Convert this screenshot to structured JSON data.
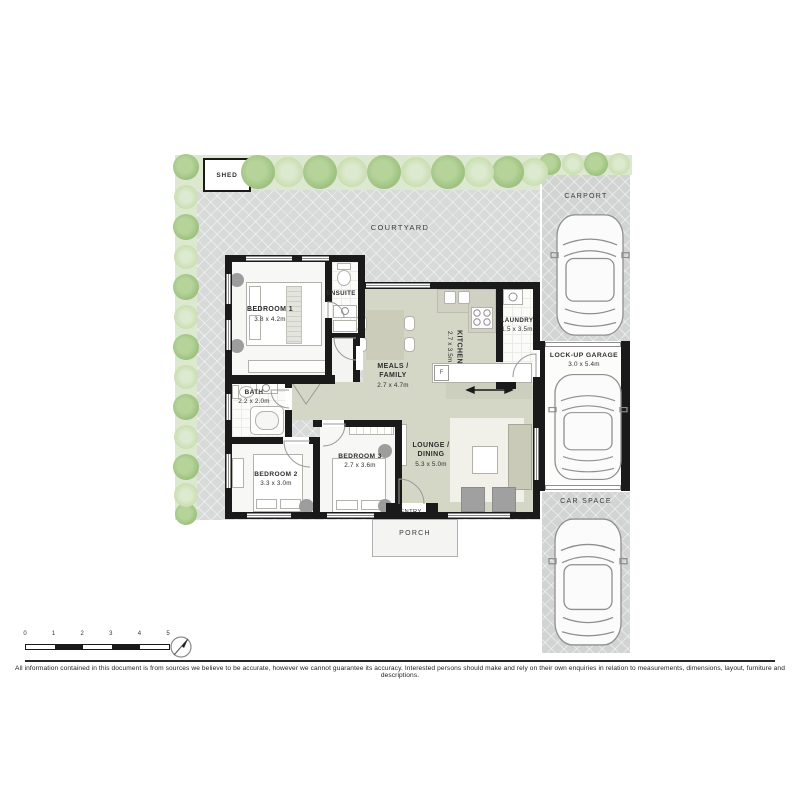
{
  "plan": {
    "shed": {
      "label": "SHED"
    },
    "courtyard": {
      "label": "COURTYARD"
    },
    "rooms": {
      "bedroom1": {
        "name": "BEDROOM 1",
        "dims": "3.8 x 4.2m"
      },
      "ensuite": {
        "name": "ENSUITE"
      },
      "kitchen": {
        "name": "KITCHEN",
        "dims": "2.7 x 3.5m"
      },
      "laundry": {
        "name": "LAUNDRY",
        "dims": "1.5 x 3.5m"
      },
      "meals_family": {
        "name": "MEALS / FAMILY",
        "dims": "2.7 x 4.7m"
      },
      "bath": {
        "name": "BATH",
        "dims": "2.2 x 2.0m"
      },
      "bedroom2": {
        "name": "BEDROOM 2",
        "dims": "3.3 x 3.0m"
      },
      "bedroom3": {
        "name": "BEDROOM 3",
        "dims": "2.7 x 3.6m"
      },
      "lounge_dining": {
        "name": "LOUNGE / DINING",
        "dims": "5.3 x 5.0m"
      },
      "entry": {
        "name": "ENTRY"
      },
      "porch": {
        "name": "PORCH"
      }
    },
    "parking": {
      "carport": {
        "name": "CARPORT"
      },
      "garage": {
        "name": "LOCK-UP GARAGE",
        "dims": "3.0 x 5.4m"
      },
      "car_space": {
        "name": "CAR SPACE"
      }
    },
    "labels": {
      "fridge": "F"
    }
  },
  "scale_bar": {
    "ticks": [
      "0",
      "1",
      "2",
      "3",
      "4",
      "5"
    ]
  },
  "footer": {
    "disclaimer": "All information contained in this document is from sources we believe to be accurate, however we cannot guarantee its accuracy. Interested persons should make and rely on their own enquiries in relation to measurements, dimensions, layout, furniture and descriptions."
  },
  "colors": {
    "wall": "#1a1a1a",
    "courtyard": "#d8dad9",
    "parking_gray": "#d2d4d3",
    "living_floor": "#d4d6c6",
    "greenery": "#dde8d0",
    "tree_dark": "#9cc07e",
    "tree_light": "#c8ddad"
  }
}
